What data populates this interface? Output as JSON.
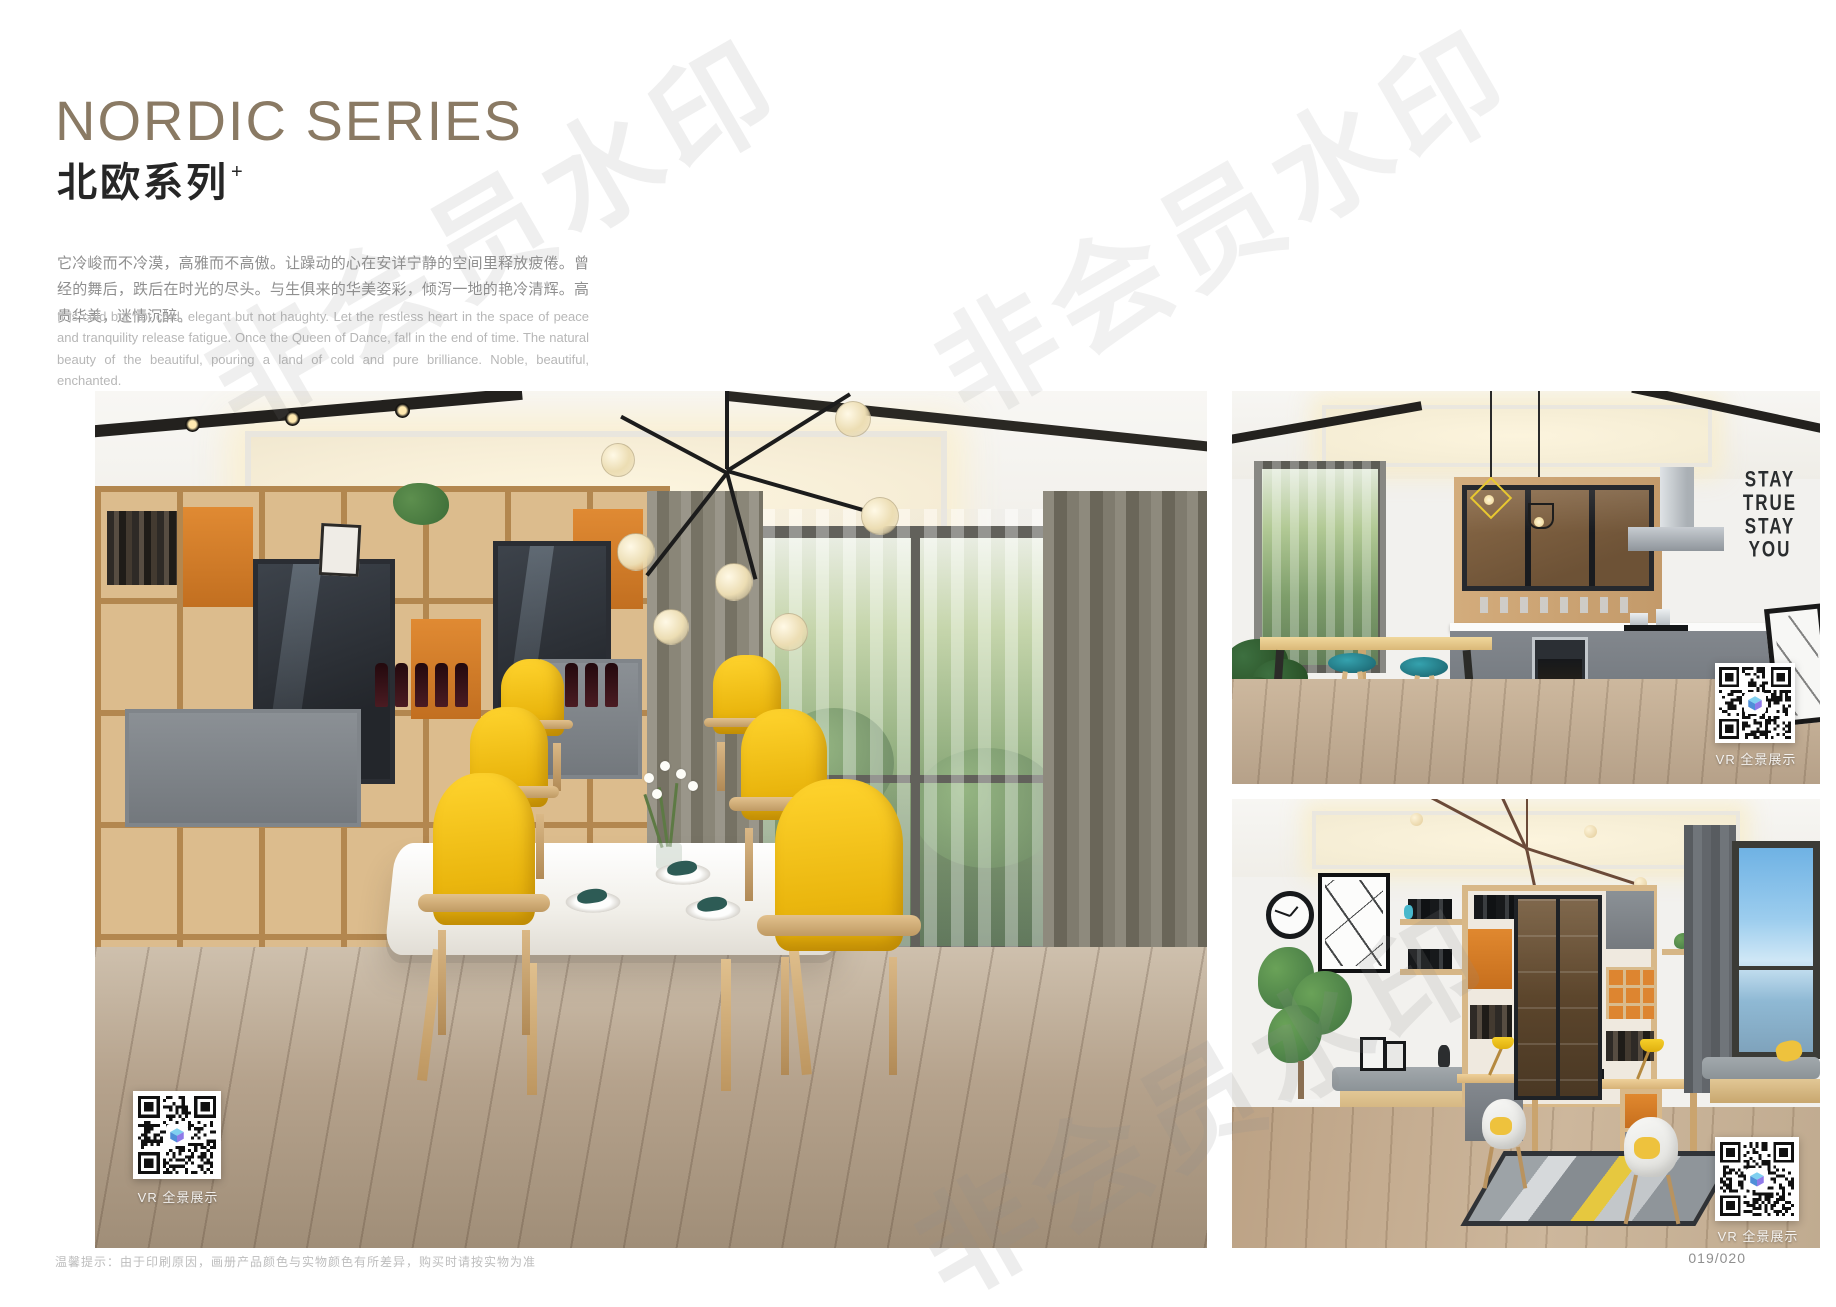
{
  "header": {
    "title_en": "NORDIC SERIES",
    "title_zh": "北欧系列",
    "title_sup": "+",
    "desc_zh": "它冷峻而不冷漠，高雅而不高傲。让躁动的心在安详宁静的空间里释放疲倦。曾经的舞后，跌后在时光的尽头。与生俱来的华美姿彩，倾泻一地的艳冷清辉。高贵华美，迷情沉醉。",
    "desc_en": "It is cold but not cold, elegant but not haughty. Let the restless heart in the space of peace and tranquility release fatigue. Once the Queen of Dance, fall in the end of time. The natural beauty of the beautiful, pouring a land of cold and pure brilliance. Noble, beautiful, enchanted."
  },
  "watermark": {
    "text": "非会员水印"
  },
  "vr": {
    "label": "VR 全景展示"
  },
  "kitchen": {
    "wall_art": [
      "STAY",
      "TRUE",
      "STAY",
      "YOU"
    ]
  },
  "footer": {
    "note": "温馨提示：由于印刷原因，画册产品颜色与实物颜色有所差异，购买时请按实物为准",
    "page_number": "019/020"
  },
  "colors": {
    "title_accent": "#8a7a64",
    "chair_yellow": "#f3c61e",
    "shelf_orange": "#dd8530",
    "stool_teal": "#2c8b97",
    "cabinet_gray": "#7f848a",
    "wood": "#d9b888"
  }
}
